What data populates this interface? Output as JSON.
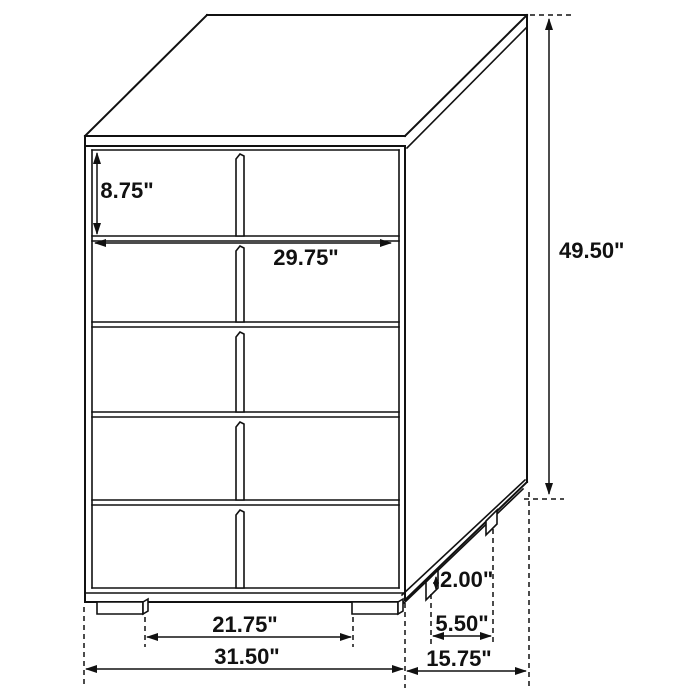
{
  "diagram": {
    "type": "furniture-dimension-diagram",
    "subject": "5-drawer chest",
    "unit": "inches",
    "drawer_rows": 5,
    "labels": {
      "drawer_height": "8.75\"",
      "drawer_width": "29.75\"",
      "overall_height": "49.50\"",
      "foot_height": "2.00\"",
      "side_foot_spacing": "5.50\"",
      "overall_depth": "15.75\"",
      "front_foot_spacing": "21.75\"",
      "overall_width": "31.50\""
    }
  }
}
